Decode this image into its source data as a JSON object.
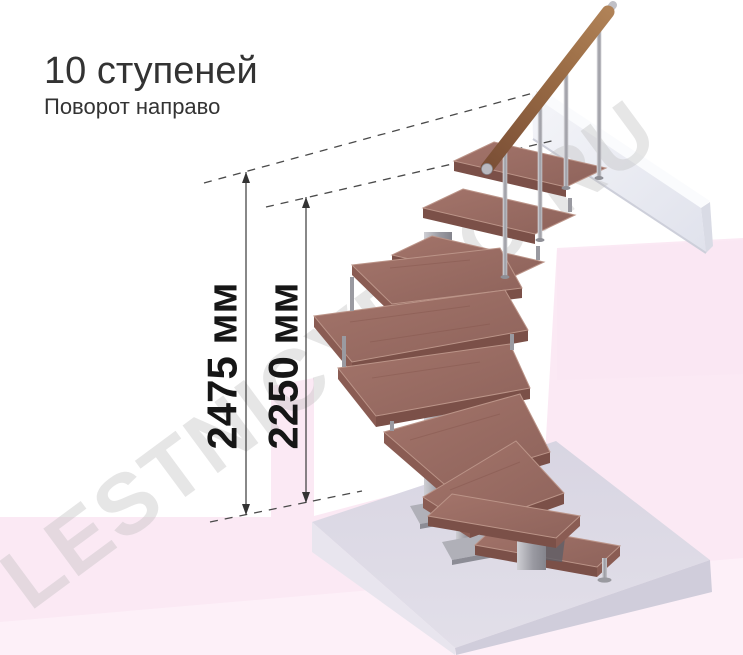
{
  "header": {
    "title": "10 ступеней",
    "subtitle": "Поворот направо"
  },
  "dimensions": {
    "total_height": "2475 мм",
    "to_top_tread": "2250 мм"
  },
  "stairs": {
    "steps_count": "10",
    "turn_direction": "направо"
  },
  "watermark": "LESTNICYPRO.RU",
  "colors": {
    "wood_top": "#9c6f66",
    "wood_front": "#7b5048",
    "handrail": "#96673f",
    "metal": "#b6b6bb",
    "floor_pink": "#fbe9f4",
    "platform_gray": "#dcd9e5",
    "beam_white": "#f0f1f6",
    "dimension_line": "#3a3a3a",
    "text": "#333333"
  }
}
